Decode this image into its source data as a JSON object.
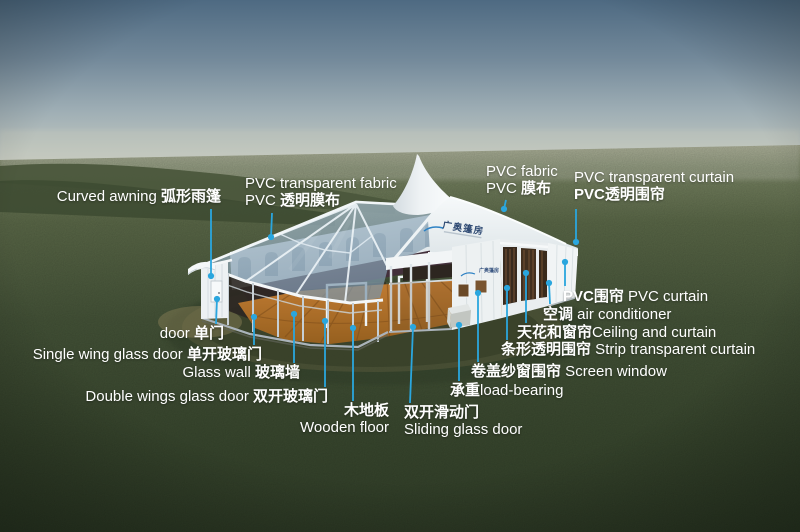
{
  "scene": {
    "logo": {
      "roof": "广奥篷房",
      "wall": "广奥篷房"
    },
    "colors": {
      "leader_blue": "#2aa6de",
      "sky_top": "#4e6a82",
      "horizon": "#c8cbc1",
      "grass_dark": "#33412a",
      "tent_white": "#f3f6f7",
      "roof_glass": "#8ea6b8",
      "wood_floor": "#b5752e",
      "label_text": "#ffffff",
      "logo_blue": "#2f4a73"
    },
    "annotations": [
      {
        "id": "curved-awning",
        "align": "right",
        "x": 221,
        "y": 188,
        "lines": [
          [
            {
              "t": "Curved awning ",
              "zh": false
            },
            {
              "t": "弧形雨篷",
              "zh": true
            }
          ]
        ],
        "leader": [
          211,
          209,
          211,
          276
        ]
      },
      {
        "id": "pvc-transparent-fabric",
        "align": "left",
        "x": 245,
        "y": 175,
        "lines": [
          [
            {
              "t": "PVC transparent fabric",
              "zh": false
            }
          ],
          [
            {
              "t": "PVC ",
              "zh": false
            },
            {
              "t": "透明膜布",
              "zh": true
            }
          ]
        ],
        "leader": [
          272,
          213,
          271,
          237
        ]
      },
      {
        "id": "pvc-fabric",
        "align": "left",
        "x": 486,
        "y": 163,
        "lines": [
          [
            {
              "t": "PVC fabric",
              "zh": false
            }
          ],
          [
            {
              "t": "PVC ",
              "zh": false
            },
            {
              "t": "膜布",
              "zh": true
            }
          ]
        ],
        "leader": [
          506,
          200,
          504,
          209
        ]
      },
      {
        "id": "pvc-transparent-curtain",
        "align": "left",
        "x": 574,
        "y": 169,
        "lines": [
          [
            {
              "t": "PVC transparent curtain",
              "zh": false
            }
          ],
          [
            {
              "t": "PVC透明围帘",
              "zh": true
            }
          ]
        ],
        "leader": [
          576,
          209,
          576,
          242
        ]
      },
      {
        "id": "door",
        "align": "right",
        "x": 224,
        "y": 325,
        "lines": [
          [
            {
              "t": "door ",
              "zh": false
            },
            {
              "t": "单门",
              "zh": true
            }
          ]
        ],
        "leader": [
          216,
          324,
          217,
          299
        ]
      },
      {
        "id": "single-wing-glass-door",
        "align": "right",
        "x": 262,
        "y": 346,
        "lines": [
          [
            {
              "t": "Single wing glass door ",
              "zh": false
            },
            {
              "t": "单开玻璃门",
              "zh": true
            }
          ]
        ],
        "leader": [
          254,
          345,
          254,
          317
        ]
      },
      {
        "id": "glass-wall",
        "align": "right",
        "x": 300,
        "y": 364,
        "lines": [
          [
            {
              "t": "Glass wall ",
              "zh": false
            },
            {
              "t": "玻璃墙",
              "zh": true
            }
          ]
        ],
        "leader": [
          294,
          363,
          294,
          314
        ]
      },
      {
        "id": "double-wings-glass-door",
        "align": "right",
        "x": 328,
        "y": 388,
        "lines": [
          [
            {
              "t": "Double wings glass door ",
              "zh": false
            },
            {
              "t": "双开玻璃门",
              "zh": true
            }
          ]
        ],
        "leader": [
          325,
          387,
          325,
          321
        ]
      },
      {
        "id": "wooden-floor",
        "align": "right",
        "x": 389,
        "y": 402,
        "lines": [
          [
            {
              "t": "木地板",
              "zh": true
            }
          ],
          [
            {
              "t": "Wooden floor",
              "zh": false
            }
          ]
        ],
        "leader": [
          353,
          401,
          353,
          328
        ]
      },
      {
        "id": "sliding-glass-door",
        "align": "left",
        "x": 404,
        "y": 404,
        "lines": [
          [
            {
              "t": "双开滑动门",
              "zh": true
            }
          ],
          [
            {
              "t": "Sliding glass door",
              "zh": false
            }
          ]
        ],
        "leader": [
          410,
          403,
          413,
          327
        ]
      },
      {
        "id": "load-bearing",
        "align": "left",
        "x": 450,
        "y": 382,
        "lines": [
          [
            {
              "t": "承重",
              "zh": true
            },
            {
              "t": "load-bearing",
              "zh": false
            }
          ]
        ],
        "leader": [
          459,
          381,
          459,
          325
        ]
      },
      {
        "id": "screen-window",
        "align": "left",
        "x": 471,
        "y": 363,
        "lines": [
          [
            {
              "t": "卷盖纱窗围帘",
              "zh": true
            },
            {
              "t": " Screen window",
              "zh": false
            }
          ]
        ],
        "leader": [
          478,
          362,
          478,
          293
        ]
      },
      {
        "id": "strip-transparent-curtain",
        "align": "left",
        "x": 501,
        "y": 341,
        "lines": [
          [
            {
              "t": "条形透明围帘",
              "zh": true
            },
            {
              "t": " Strip transparent curtain",
              "zh": false
            }
          ]
        ],
        "leader": [
          507,
          340,
          507,
          288
        ]
      },
      {
        "id": "ceiling-and-curtain",
        "align": "left",
        "x": 517,
        "y": 324,
        "lines": [
          [
            {
              "t": "天花和窗帘",
              "zh": true
            },
            {
              "t": "Ceiling and curtain",
              "zh": false
            }
          ]
        ],
        "leader": [
          526,
          323,
          526,
          273
        ]
      },
      {
        "id": "air-conditioner",
        "align": "left",
        "x": 543,
        "y": 306,
        "lines": [
          [
            {
              "t": "空调",
              "zh": true
            },
            {
              "t": "  air conditioner",
              "zh": false
            }
          ]
        ],
        "leader": [
          550,
          304,
          549,
          283
        ]
      },
      {
        "id": "pvc-curtain",
        "align": "left",
        "x": 563,
        "y": 288,
        "lines": [
          [
            {
              "t": "PVC围帘",
              "zh": true
            },
            {
              "t": " PVC  curtain",
              "zh": false
            }
          ]
        ],
        "leader": [
          565,
          286,
          565,
          262
        ]
      }
    ]
  }
}
